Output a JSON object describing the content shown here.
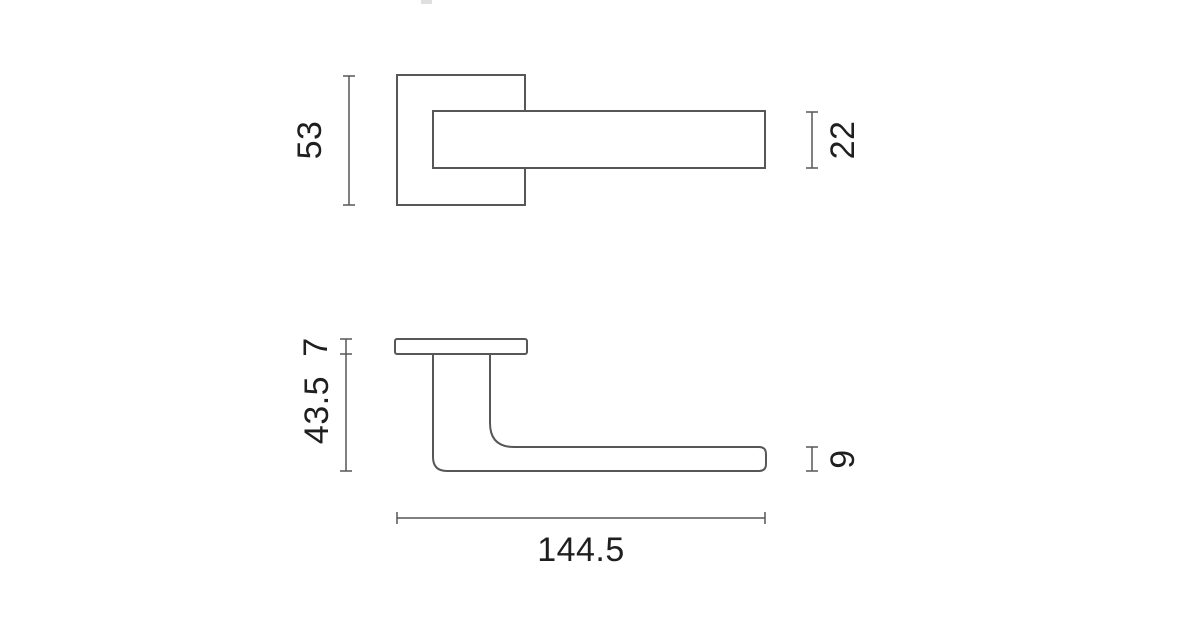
{
  "page": {
    "background": "#ffffff"
  },
  "drawing": {
    "description": "Two-view dimensioned technical drawing of a door lever handle on a square rosette",
    "line_color": "#57575a",
    "label_color": "#1f1f1f",
    "artifact_color": "#c4c4c4",
    "front_view": {
      "rosette_height": "53",
      "lever_thickness": "22"
    },
    "side_view": {
      "rosette_thickness": "7",
      "handle_projection": "43.5",
      "lever_depth": "9",
      "overall_length": "144.5"
    }
  }
}
